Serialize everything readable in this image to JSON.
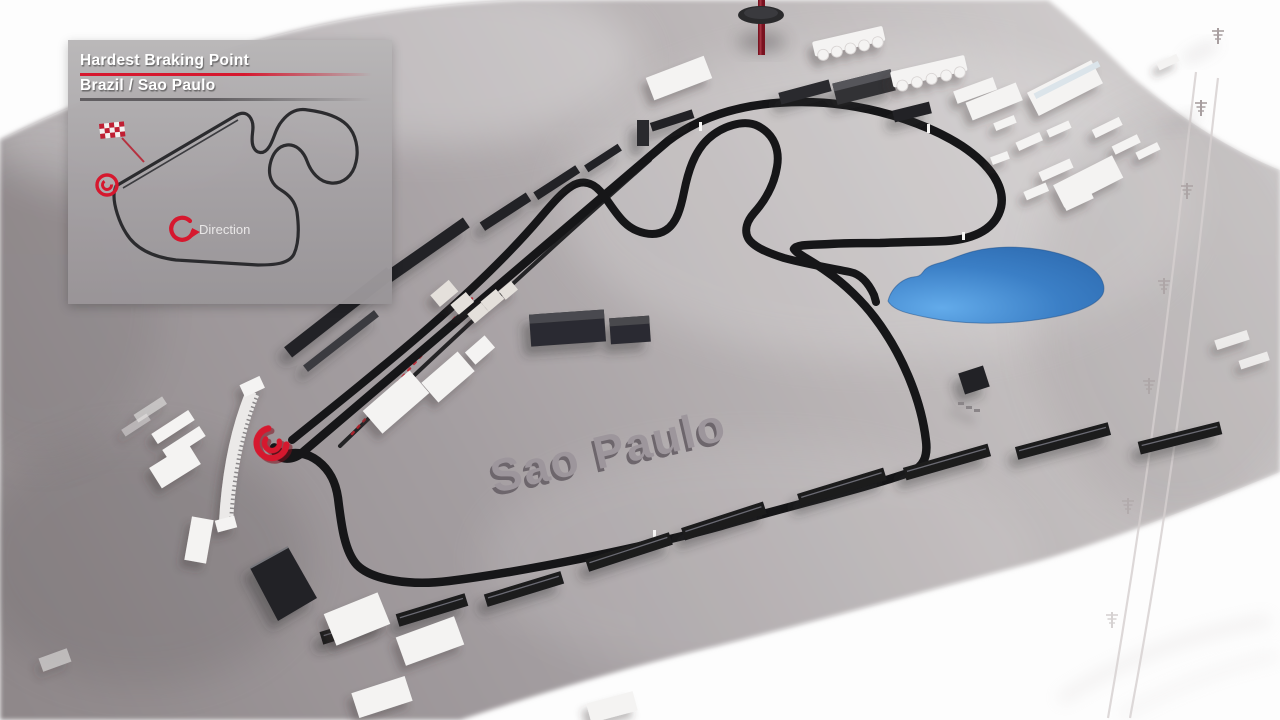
{
  "panel": {
    "title": "Hardest Braking Point",
    "subtitle": "Brazil / Sao Paulo",
    "direction_label": "Direction"
  },
  "scene": {
    "city_label": "Sao Paulo"
  },
  "colors": {
    "accent_red": "#d6182e",
    "track": "#161618",
    "lake_blue": "#3b7fc6",
    "terrain": "#aba5a7",
    "panel_gray": "#aeabac",
    "building_white": "#f4f3f2",
    "building_dark": "#232327"
  },
  "icons": {
    "checkered_flag_icon": "red-white checkered flag",
    "direction_arrow_icon": "clockwise circular arrow",
    "braking_marker_icon": "red spiral swirl",
    "power_pylon_icon": "transmission tower"
  }
}
